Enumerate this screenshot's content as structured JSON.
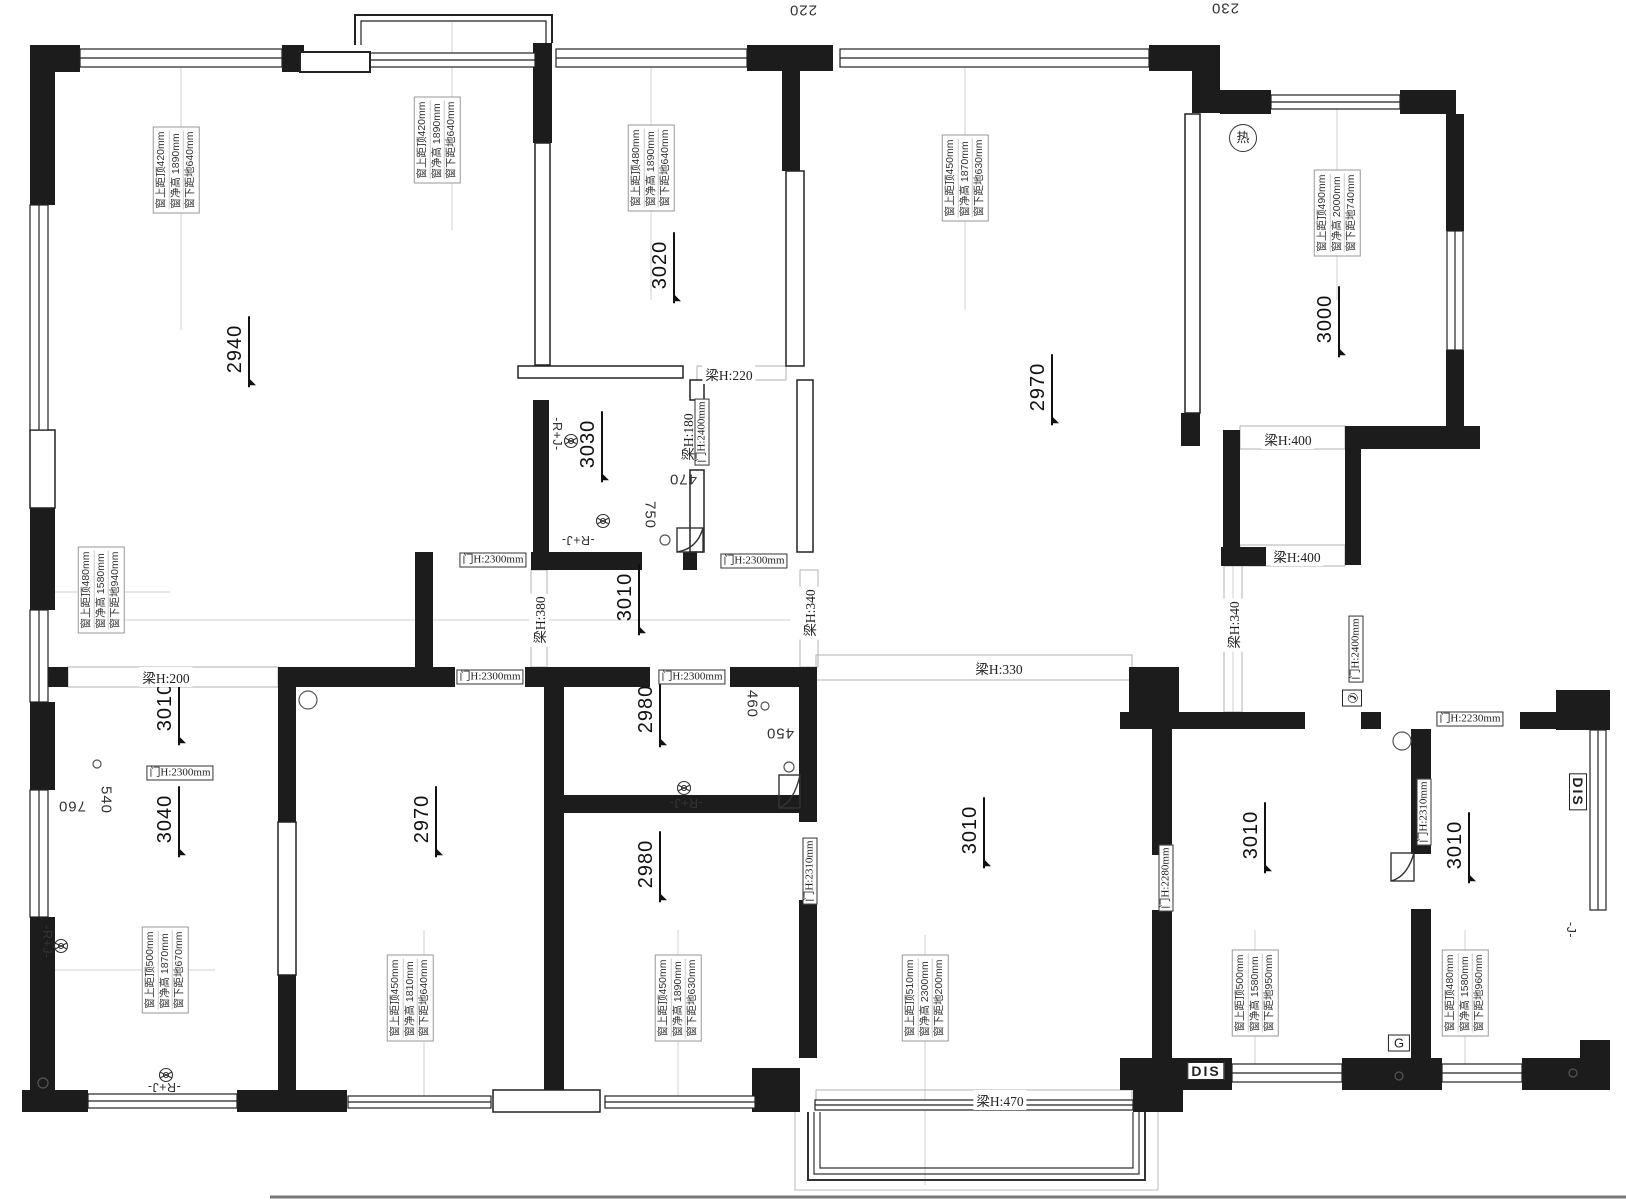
{
  "drawing": {
    "type": "apartment floor plan with ceiling/beam/window height annotations",
    "colors": {
      "wall": "#1c1c1c",
      "line": "#222222",
      "guide": "#cfcfcf",
      "beam_outline": "#b0b0b0"
    }
  },
  "rooms": [
    {
      "value": "2940",
      "x": 237,
      "y": 352
    },
    {
      "value": "3020",
      "x": 662,
      "y": 268
    },
    {
      "value": "3030",
      "x": 590,
      "y": 447
    },
    {
      "value": "2970",
      "x": 1040,
      "y": 390
    },
    {
      "value": "3000",
      "x": 1327,
      "y": 322
    },
    {
      "value": "3010",
      "x": 627,
      "y": 600
    },
    {
      "value": "3010",
      "x": 167,
      "y": 710
    },
    {
      "value": "3040",
      "x": 167,
      "y": 822
    },
    {
      "value": "2970",
      "x": 424,
      "y": 822
    },
    {
      "value": "2980",
      "x": 648,
      "y": 712
    },
    {
      "value": "2980",
      "x": 648,
      "y": 867
    },
    {
      "value": "3010",
      "x": 972,
      "y": 833
    },
    {
      "value": "3010",
      "x": 1253,
      "y": 838
    },
    {
      "value": "3010",
      "x": 1457,
      "y": 848
    }
  ],
  "window_annotations": [
    {
      "x": 176,
      "y": 170,
      "lines": [
        "窗上距顶420mm",
        "窗净高 1890mm",
        "窗下距地640mm"
      ]
    },
    {
      "x": 437,
      "y": 140,
      "lines": [
        "窗上距顶420mm",
        "窗净高 1890mm",
        "窗下距地640mm"
      ]
    },
    {
      "x": 651,
      "y": 168,
      "lines": [
        "窗上距顶480mm",
        "窗净高 1890mm",
        "窗下距地640mm"
      ]
    },
    {
      "x": 965,
      "y": 178,
      "lines": [
        "窗上距顶450mm",
        "窗净高 1870mm",
        "窗下距地630mm"
      ]
    },
    {
      "x": 1337,
      "y": 213,
      "lines": [
        "窗上距顶490mm",
        "窗净高 2000mm",
        "窗下距地740mm"
      ]
    },
    {
      "x": 101,
      "y": 590,
      "lines": [
        "窗上距顶480mm",
        "窗净高 1580mm",
        "窗下距地940mm"
      ]
    },
    {
      "x": 165,
      "y": 970,
      "lines": [
        "窗上距顶500mm",
        "窗净高 1870mm",
        "窗下距地670mm"
      ]
    },
    {
      "x": 410,
      "y": 998,
      "lines": [
        "窗上距顶450mm",
        "窗净高 1810mm",
        "窗下距地640mm"
      ]
    },
    {
      "x": 678,
      "y": 998,
      "lines": [
        "窗上距顶450mm",
        "窗净高 1890mm",
        "窗下距地630mm"
      ]
    },
    {
      "x": 925,
      "y": 998,
      "lines": [
        "窗上距顶510mm",
        "窗净高 2300mm",
        "窗下距地200mm"
      ]
    },
    {
      "x": 1255,
      "y": 993,
      "lines": [
        "窗上距顶500mm",
        "窗净高 1580mm",
        "窗下距地950mm"
      ]
    },
    {
      "x": 1465,
      "y": 993,
      "lines": [
        "窗上距顶480mm",
        "窗净高 1580mm",
        "窗下距地960mm"
      ]
    }
  ],
  "beam_labels": [
    {
      "text": "梁H:220",
      "x": 729,
      "y": 374,
      "rot": 0
    },
    {
      "text": "梁H:200",
      "x": 166,
      "y": 677,
      "rot": 0
    },
    {
      "text": "梁H:330",
      "x": 999,
      "y": 668,
      "rot": 0
    },
    {
      "text": "梁H:400",
      "x": 1288,
      "y": 439,
      "rot": 0
    },
    {
      "text": "梁H:400",
      "x": 1297,
      "y": 556,
      "rot": 0
    },
    {
      "text": "梁H:470",
      "x": 1000,
      "y": 1100,
      "rot": 0
    },
    {
      "text": "梁H:380",
      "x": 539,
      "y": 620,
      "rot": -90
    },
    {
      "text": "梁H:340",
      "x": 809,
      "y": 613,
      "rot": -90
    },
    {
      "text": "梁H:180",
      "x": 687,
      "y": 437,
      "rot": -90
    },
    {
      "text": "梁H:340",
      "x": 1233,
      "y": 625,
      "rot": -90
    }
  ],
  "door_labels": [
    {
      "text": "门H:2300mm",
      "x": 493,
      "y": 560,
      "rot": 0
    },
    {
      "text": "门H:2300mm",
      "x": 754,
      "y": 561,
      "rot": 0
    },
    {
      "text": "门H:2300mm",
      "x": 180,
      "y": 773,
      "rot": 0
    },
    {
      "text": "门H:2300mm",
      "x": 490,
      "y": 677,
      "rot": 0
    },
    {
      "text": "门H:2300mm",
      "x": 692,
      "y": 677,
      "rot": 0
    },
    {
      "text": "门H:2230mm",
      "x": 1470,
      "y": 719,
      "rot": 0
    },
    {
      "text": "门H:2400mm",
      "x": 702,
      "y": 432,
      "rot": -90
    },
    {
      "text": "门H:2400mm",
      "x": 1356,
      "y": 649,
      "rot": -90
    },
    {
      "text": "门H:2310mm",
      "x": 810,
      "y": 871,
      "rot": -90
    },
    {
      "text": "门H:2280mm",
      "x": 1166,
      "y": 878,
      "rot": -90
    },
    {
      "text": "门H:2310mm",
      "x": 1424,
      "y": 812,
      "rot": -90
    }
  ],
  "dim_labels": [
    {
      "text": "750",
      "x": 650,
      "y": 515,
      "rot": 90
    },
    {
      "text": "470",
      "x": 683,
      "y": 479,
      "rot": 180
    },
    {
      "text": "460",
      "x": 752,
      "y": 704,
      "rot": 90
    },
    {
      "text": "450",
      "x": 780,
      "y": 733,
      "rot": 180
    },
    {
      "text": "540",
      "x": 106,
      "y": 800,
      "rot": 90
    },
    {
      "text": "760",
      "x": 72,
      "y": 806,
      "rot": 180
    },
    {
      "text": "220",
      "x": 803,
      "y": 10,
      "rot": 180
    },
    {
      "text": "230",
      "x": 1225,
      "y": 8,
      "rot": 180
    }
  ],
  "pipe_labels": [
    {
      "text": "-R+J-",
      "x": 557,
      "y": 434,
      "rot": 90
    },
    {
      "text": "-R+J-",
      "x": 578,
      "y": 540,
      "rot": 180
    },
    {
      "text": "-R+J-",
      "x": 47,
      "y": 942,
      "rot": 90
    },
    {
      "text": "-R+J-",
      "x": 164,
      "y": 1087,
      "rot": 180
    },
    {
      "text": "-R+J-",
      "x": 686,
      "y": 803,
      "rot": 180
    },
    {
      "text": "-J-",
      "x": 1571,
      "y": 930,
      "rot": 90
    }
  ],
  "marker_boxes": [
    {
      "text": "DIS",
      "x": 1206,
      "y": 1071,
      "cls": "disbox",
      "rot": 0
    },
    {
      "text": "DIS",
      "x": 1578,
      "y": 792,
      "cls": "disbox",
      "rot": 90
    },
    {
      "text": "G",
      "x": 1399,
      "y": 1043,
      "cls": "gbox",
      "rot": 0
    },
    {
      "text": "热",
      "x": 1243,
      "y": 138,
      "cls": "hot",
      "rot": 0
    },
    {
      "text": "✆",
      "x": 1352,
      "y": 698,
      "cls": "phone",
      "rot": 90
    }
  ]
}
